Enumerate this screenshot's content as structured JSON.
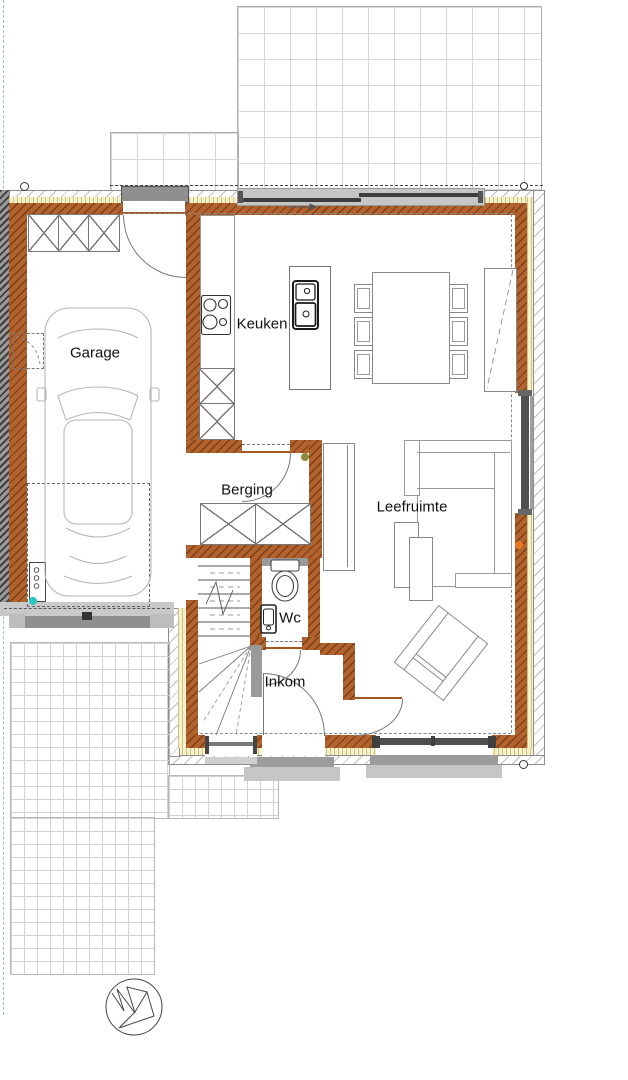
{
  "rooms": {
    "garage": "Garage",
    "keuken": "Keuken",
    "berging": "Berging",
    "leefruimte": "Leefruimte",
    "wc": "Wc",
    "inkom": "Inkom"
  },
  "colors": {
    "brick": "#b2622d",
    "insulation": "#f6f1c8",
    "exterior_hatch_line": "#bdbdbd",
    "party_wall": "#4a4a4a",
    "glazing": "#4f4f4f",
    "lintel_gray": "#8f8f8f",
    "pad_gray": "#c6c6c6",
    "boundary_blue": "#a3b8d6",
    "dot_cyan": "#2cc5c5",
    "dot_olive": "#8b8b3a",
    "dot_orange": "#e8791f"
  },
  "icons": {
    "north_arrow": "north-arrow"
  }
}
